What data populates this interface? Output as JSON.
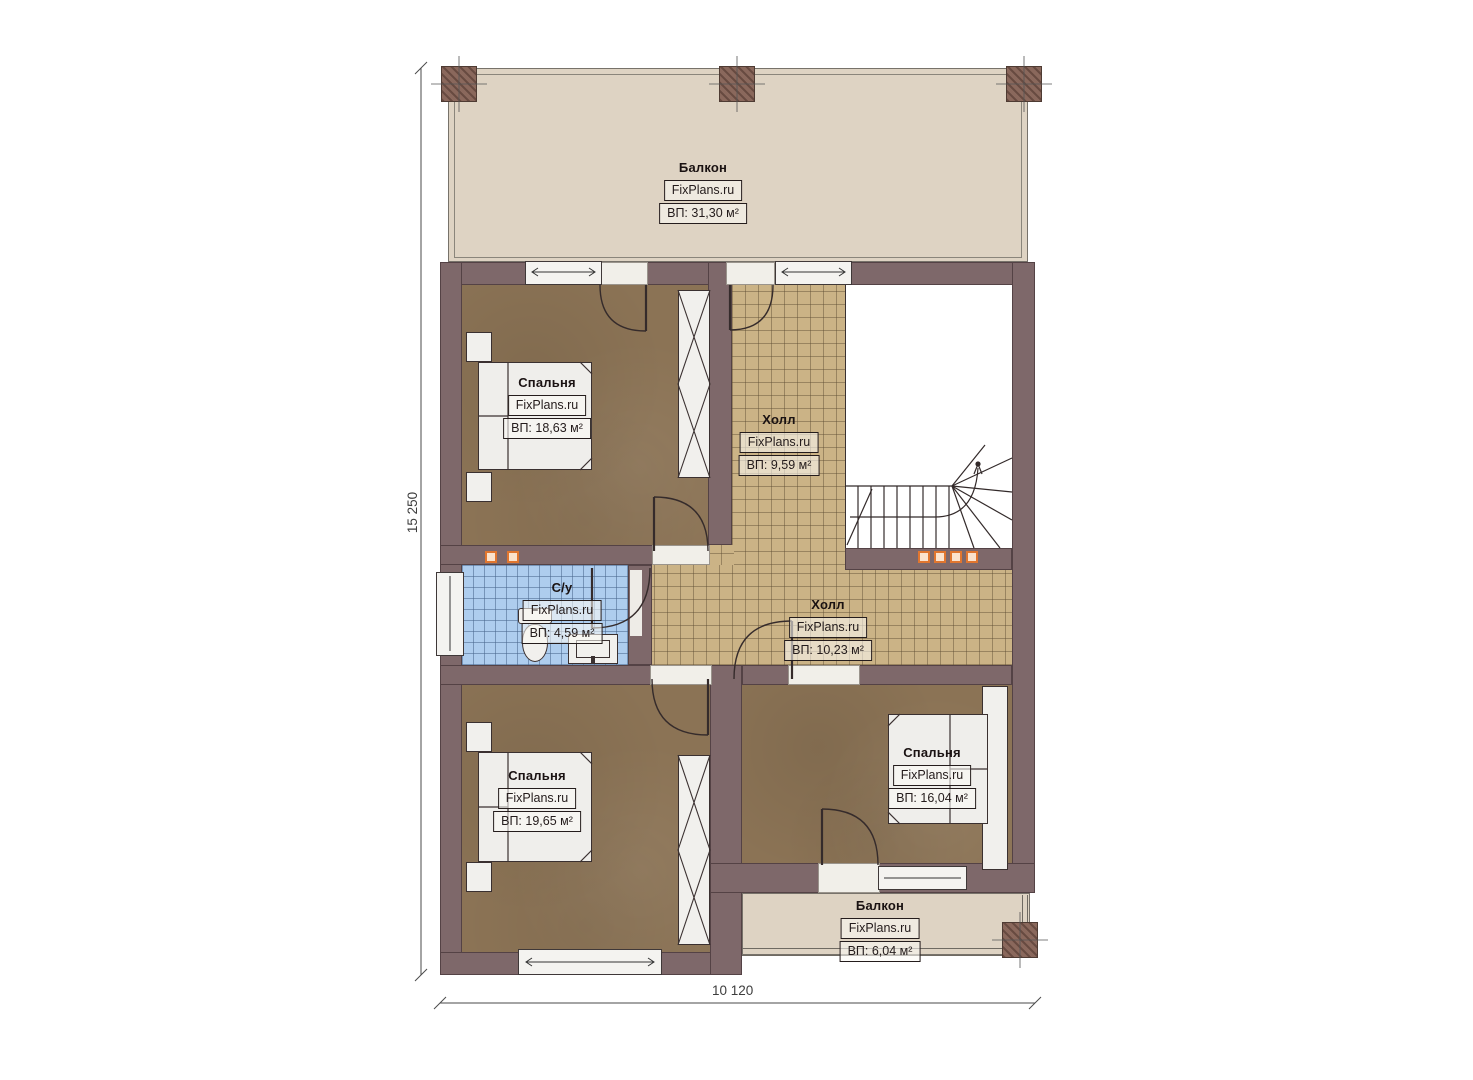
{
  "plan": {
    "brand": "FixPlans.ru",
    "dimensions": {
      "vertical": "15 250",
      "horizontal": "10 120"
    },
    "rooms": [
      {
        "key": "balcony-top",
        "name": "Балкон",
        "area": "ВП: 31,30 м²"
      },
      {
        "key": "bedroom-top-left",
        "name": "Спальня",
        "area": "ВП: 18,63 м²"
      },
      {
        "key": "hall-upper",
        "name": "Холл",
        "area": "ВП: 9,59 м²"
      },
      {
        "key": "bathroom",
        "name": "С/у",
        "area": "ВП: 4,59 м²"
      },
      {
        "key": "hall-lower",
        "name": "Холл",
        "area": "ВП: 10,23 м²"
      },
      {
        "key": "bedroom-bottom-left",
        "name": "Спальня",
        "area": "ВП: 19,65 м²"
      },
      {
        "key": "bedroom-bottom-right",
        "name": "Спальня",
        "area": "ВП: 16,04 м²"
      },
      {
        "key": "balcony-bottom",
        "name": "Балкон",
        "area": "ВП: 6,04 м²"
      }
    ],
    "colors": {
      "wall": "#7e686a",
      "bedroom_floor": "#8b7355",
      "hall_tile": "#cbb386",
      "bathroom_tile": "#aecdee",
      "balcony_floor": "#ded3c3",
      "light_accent": "#e0762f"
    }
  }
}
